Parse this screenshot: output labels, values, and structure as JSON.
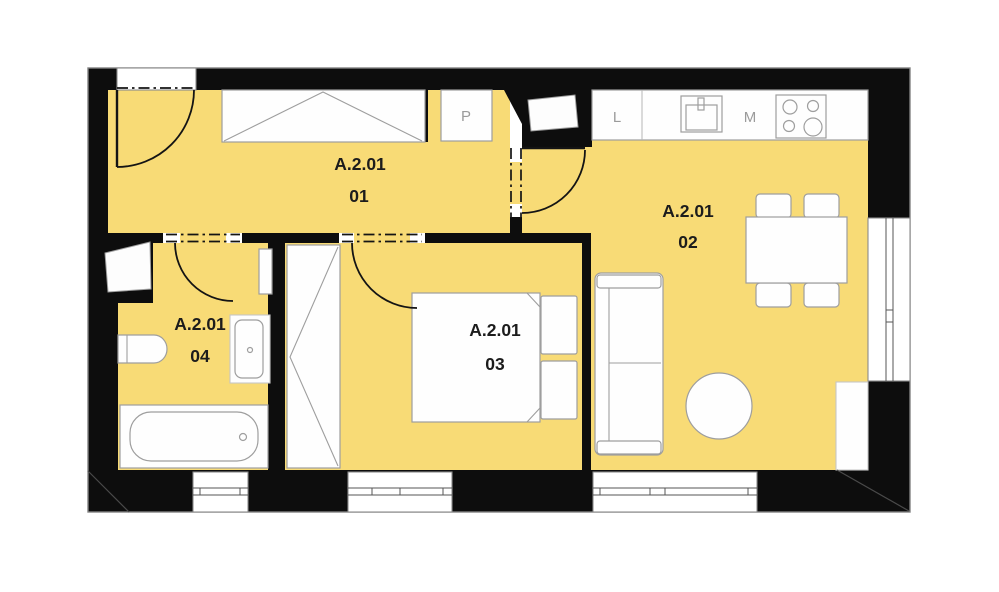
{
  "plan": {
    "unit_code": "A.2.01",
    "rooms": [
      {
        "code": "A.2.01",
        "number": "01",
        "name": "hallway"
      },
      {
        "code": "A.2.01",
        "number": "02",
        "name": "living-room-with-kitchen"
      },
      {
        "code": "A.2.01",
        "number": "03",
        "name": "bedroom"
      },
      {
        "code": "A.2.01",
        "number": "04",
        "name": "bathroom"
      }
    ],
    "appliance_labels": {
      "shaft": "P",
      "fridge": "L",
      "washing_machine": "M"
    },
    "colors": {
      "room_fill": "#f8db76",
      "wall": "#0d0d0d",
      "fixture_stroke": "#9e9e9e",
      "fixture_fill": "#fefefe",
      "label_text": "#1c1c1c",
      "letter_text": "#9b9b9b",
      "page_bg": "#ffffff"
    }
  }
}
